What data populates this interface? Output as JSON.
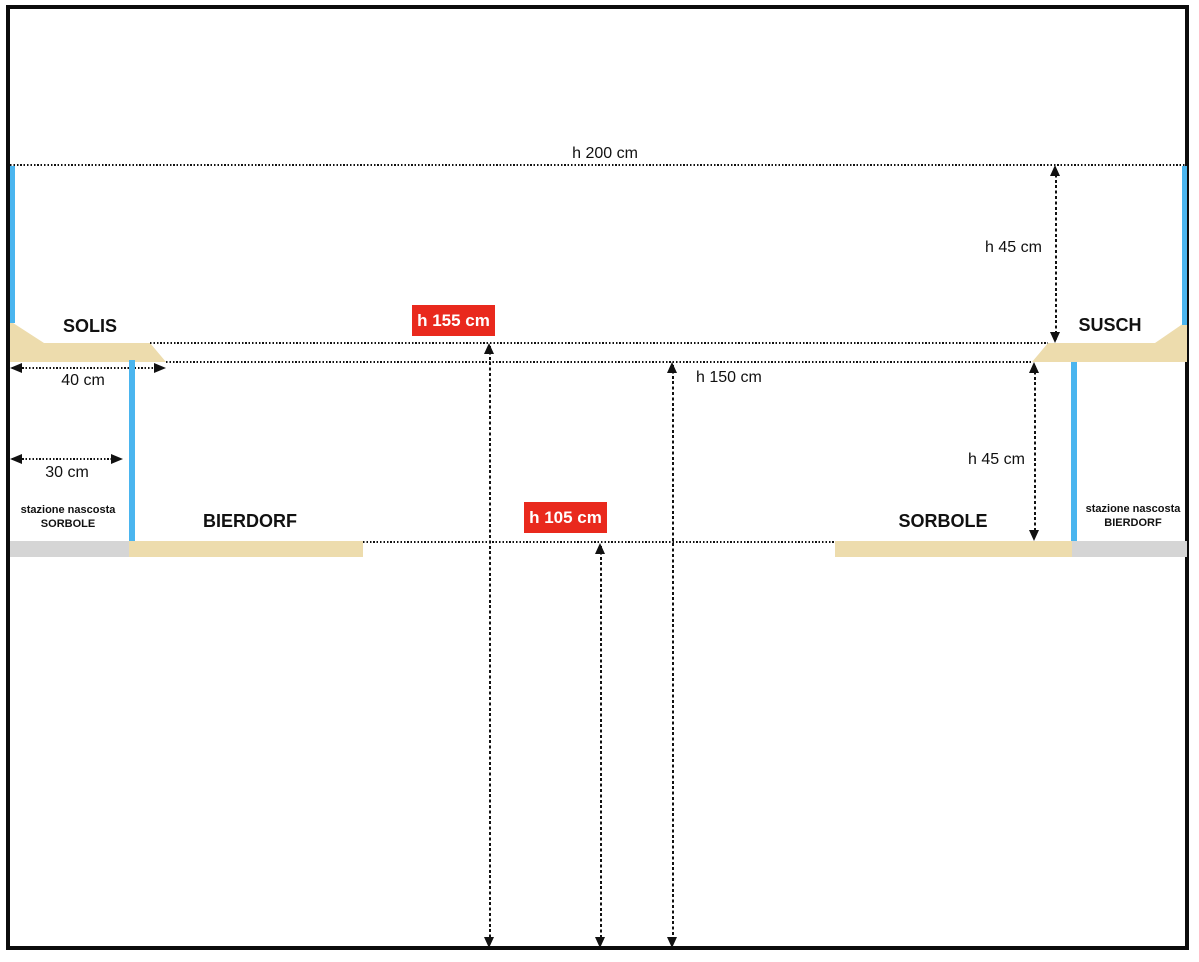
{
  "colors": {
    "accent_red": "#e9291d",
    "platform_tan": "#eddcad",
    "track_blue": "#4ab5ef",
    "hidden_gray": "#d5d5d5",
    "line_black": "#111111"
  },
  "measurements": {
    "h200": "h 200 cm",
    "h155": "h 155 cm",
    "h150": "h 150 cm",
    "h105": "h 105 cm",
    "h45_upper": "h 45 cm",
    "h45_lower": "h 45 cm",
    "depth40": "40 cm",
    "depth30": "30 cm"
  },
  "stations": {
    "solis": "SOLIS",
    "susch": "SUSCH",
    "bierdorf": "BIERDORF",
    "sorbole": "SORBOLE"
  },
  "hidden_stations": {
    "left_line1": "stazione nascosta",
    "left_line2": "SORBOLE",
    "right_line1": "stazione nascosta",
    "right_line2": "BIERDORF"
  }
}
